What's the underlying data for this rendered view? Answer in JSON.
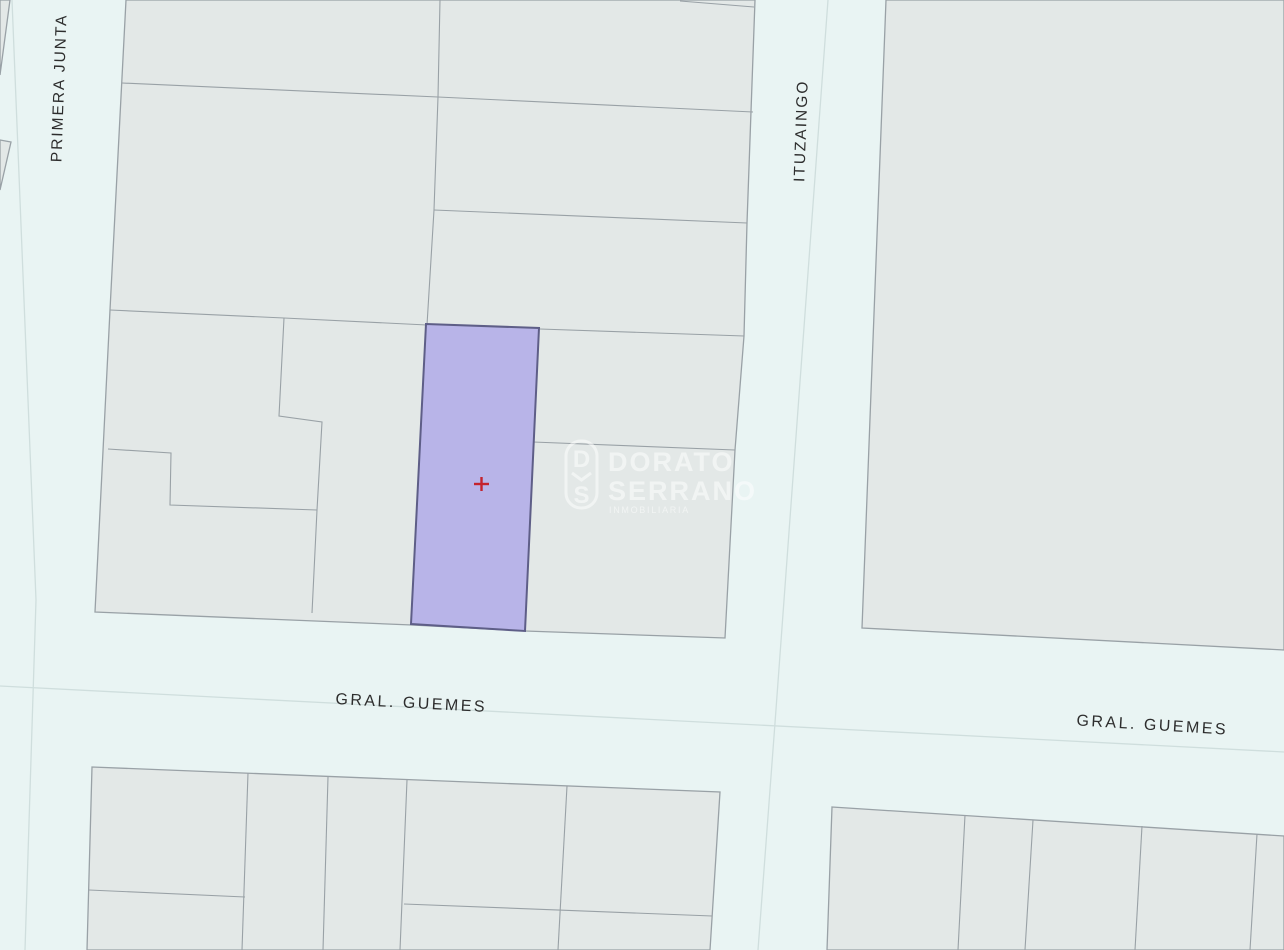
{
  "map": {
    "street_labels": {
      "primera_junta": "PRIMERA JUNTA",
      "ituzaingo": "ITUZAINGO",
      "gral_guemes_left": "GRAL. GUEMES",
      "gral_guemes_right": "GRAL. GUEMES"
    },
    "watermark": {
      "monogram_top": "D",
      "monogram_bottom": "S",
      "name_line1": "DORATO",
      "name_line2": "SERRANO",
      "tagline": "INMOBILIARIA"
    },
    "colors": {
      "street": "#e9f4f3",
      "block": "#e3e8e7",
      "block_border": "#99a1a6",
      "centerline": "#cfdedd",
      "highlight_fill": "#b8b4e8",
      "highlight_border": "#5e5e87",
      "marker": "#c4232d",
      "label": "#2d2d2d",
      "watermark": "#ffffff"
    }
  }
}
